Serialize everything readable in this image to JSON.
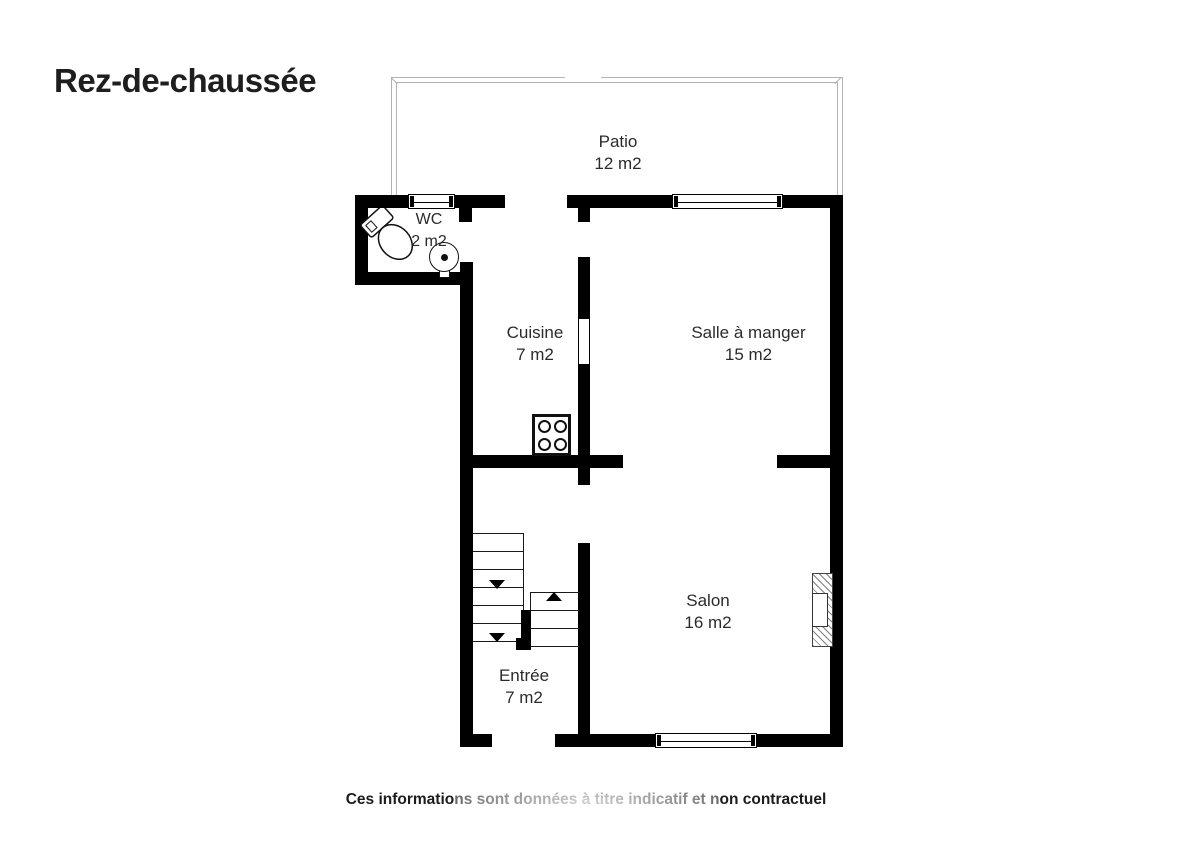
{
  "title": "Rez-de-chaussée",
  "rooms": {
    "patio": {
      "name": "Patio",
      "area": "12 m2"
    },
    "wc": {
      "name": "WC",
      "area": "2 m2"
    },
    "cuisine": {
      "name": "Cuisine",
      "area": "7 m2"
    },
    "salle": {
      "name": "Salle à manger",
      "area": "15 m2"
    },
    "salon": {
      "name": "Salon",
      "area": "16 m2"
    },
    "entree": {
      "name": "Entrée",
      "area": "7 m2"
    }
  },
  "disclaimer": "Ces informations sont données à titre indicatif et non contractuel",
  "colors": {
    "wall": "#000000",
    "line": "#1a1a1a",
    "patio": "#b3b3b3",
    "text": "#2b2b2b"
  }
}
